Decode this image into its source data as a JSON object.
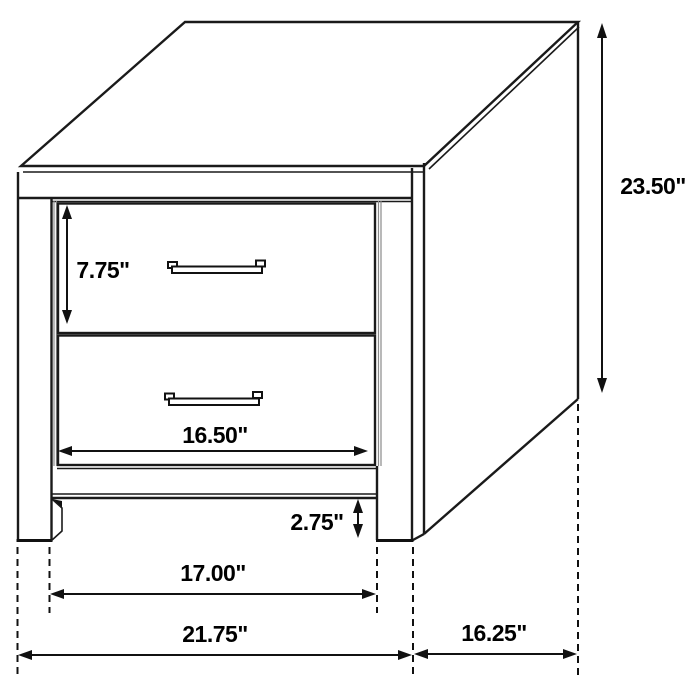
{
  "diagram": {
    "kind": "furniture-dimension-diagram",
    "unit_symbol": "\"",
    "colors": {
      "line": "#1a1a1a",
      "annotation": "#111111",
      "background": "#ffffff"
    },
    "dimensions": {
      "drawer_height": "7.75\"",
      "drawer_width": "16.50\"",
      "overall_height": "23.50\"",
      "base_clearance": "2.75\"",
      "leg_span_width": "17.00\"",
      "overall_width": "21.75\"",
      "overall_depth": "16.25\""
    }
  }
}
